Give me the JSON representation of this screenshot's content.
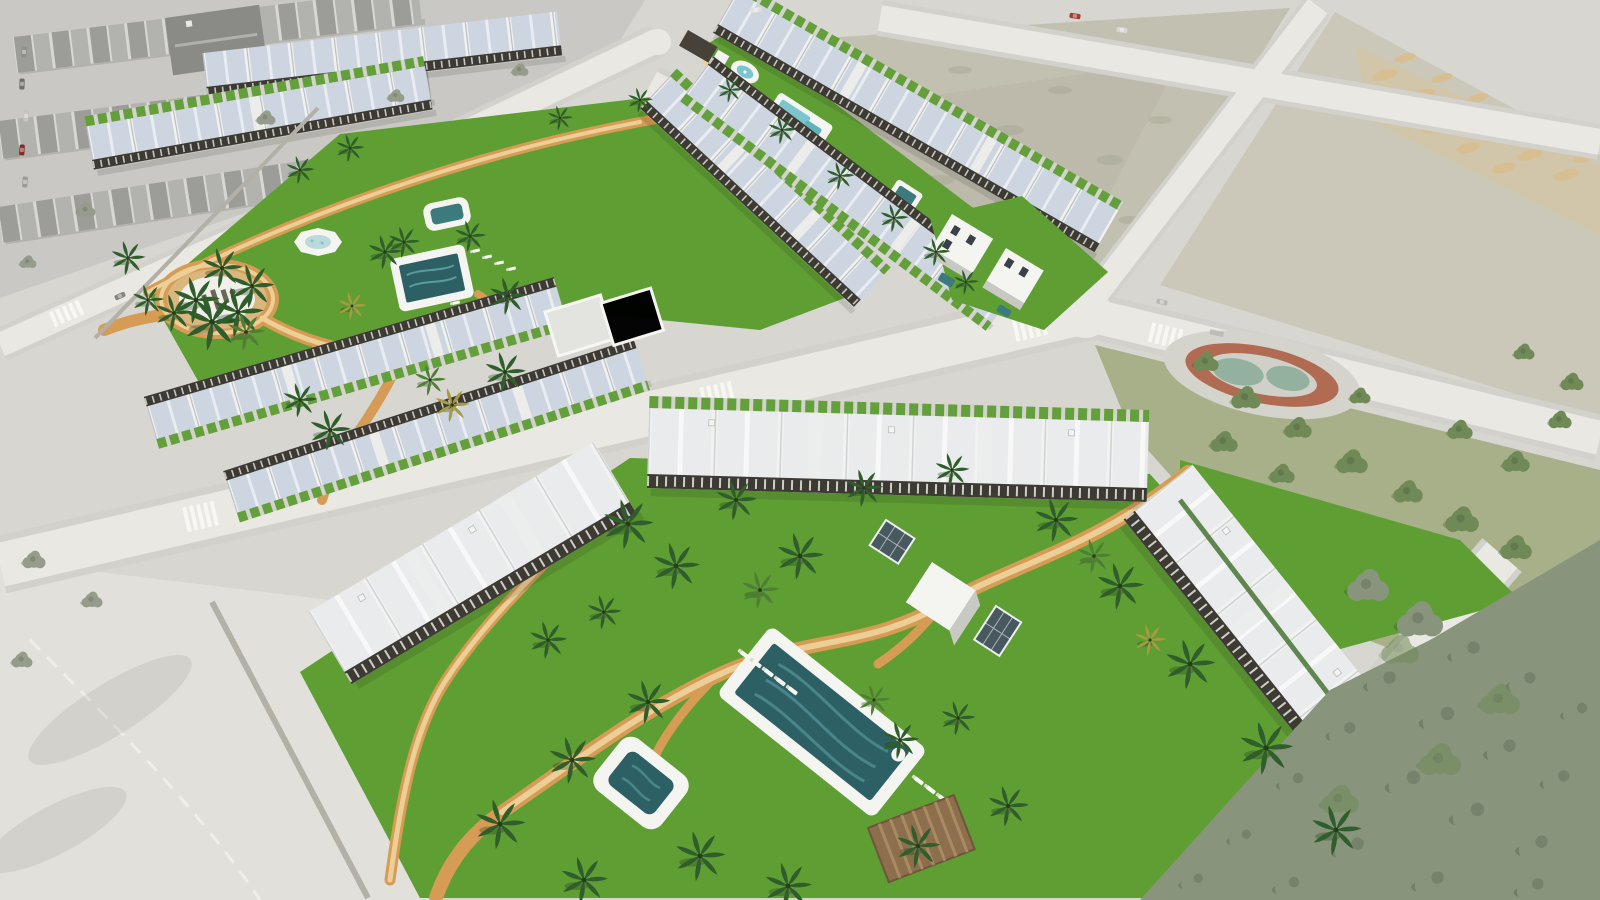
{
  "scene": {
    "type": "aerial-architectural-render",
    "subject": "new-build residential complexes with communal lawns, swimming pools and palm trees, surrounded by desaturated streets, vacant plots, a park and an existing town",
    "complexes_visible": 3,
    "pools_visible": 7,
    "plaza_emblem": "illegible dark lettering on white circular plaza"
  },
  "palette": {
    "ground": "#d7d6d1",
    "concrete": "#e1e0db",
    "road": "#e9e8e3",
    "sidewalk": "#d2d1cb",
    "city_block": "#c9c8c4",
    "lawn": "#5f9e33",
    "lawn_muted": "#a7b089",
    "hedge": "#3f6e28",
    "path": "#d69c55",
    "path_light": "#eccf97",
    "deck": "#f4f4f0",
    "pool_deep": "#2d6065",
    "pool_mid": "#3d7a7e",
    "pool_light": "#7ac6cc",
    "building": "#f3f3ef",
    "roof_pale": "#ccd5e0",
    "pergola": "#3d3a33",
    "wall": "#b3b0a7",
    "palm": "#2f5d2b",
    "palm_light": "#4e7f35",
    "palm_yellow": "#a79b41",
    "tree_park": "#6f8a57",
    "tree_gray": "#969c8b",
    "tree_mass": "#88957c",
    "scrub": "#c2c0b1",
    "lot": "#cbc8b9",
    "dirt": "#d7bf92",
    "speckle": "#a9a795",
    "track_red": "#b26b53",
    "track_teal": "#94b19f",
    "wood": "#8d6f4e",
    "glass": "#47585f",
    "car_red": "#a33c31"
  }
}
